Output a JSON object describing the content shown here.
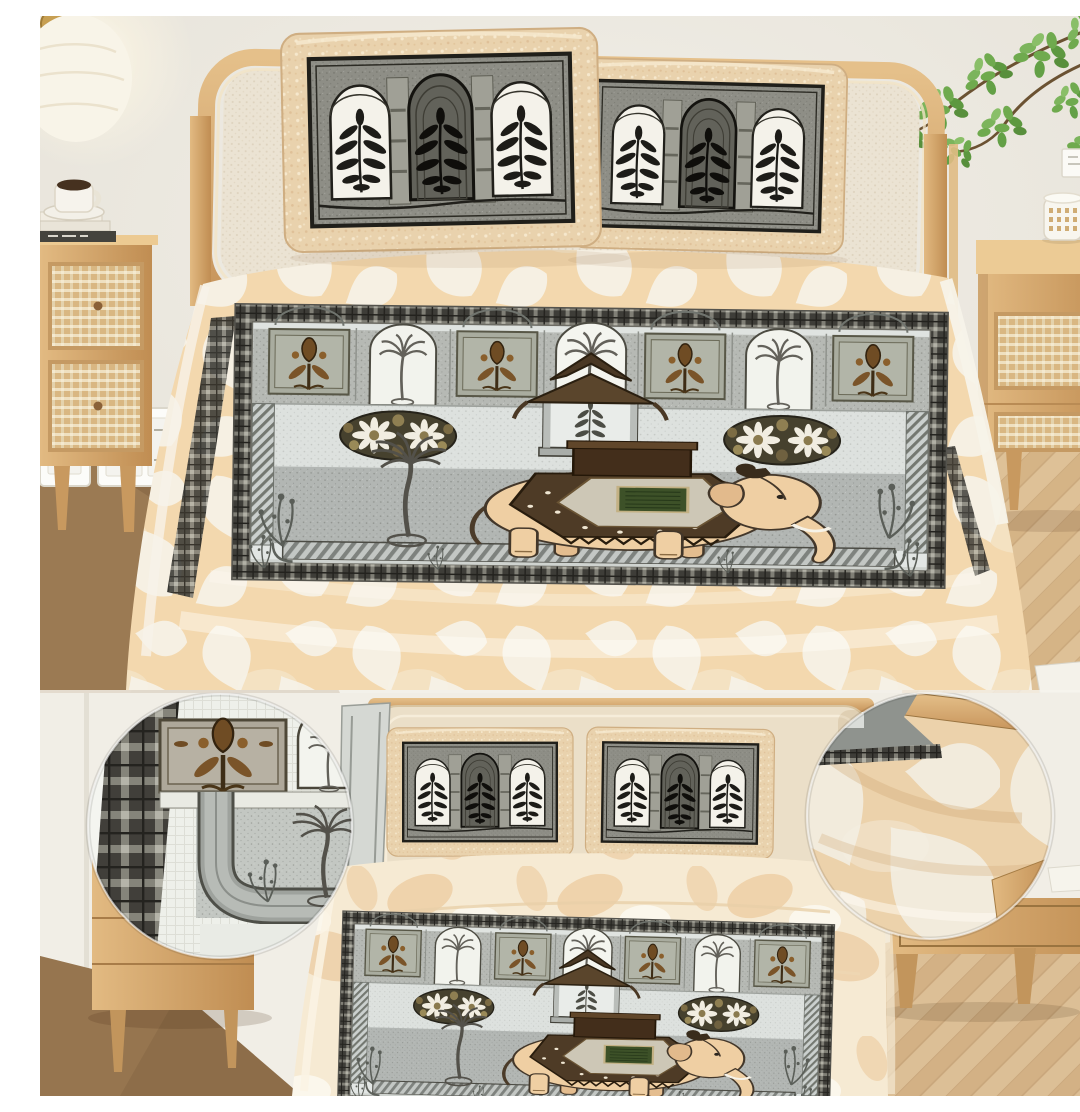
{
  "meta": {
    "title": "Elephant and Mughal-arch block-print jacquard bedsheet set with two pillow covers, styled bedroom product photo",
    "canvas": {
      "width": 1080,
      "height": 1080
    },
    "text_visible_in_image": false
  },
  "palette": {
    "wall": "#edeae2",
    "wall_shadow": "#e0dcd2",
    "wood": "#d5a873",
    "wood_dark": "#b9854f",
    "floor_dark": "#8d6d49",
    "floor_light": "#d6b488",
    "sheet_peach": "#f3d8ae",
    "leaf_white": "#f7f2e6",
    "sheet_cream": "#f6ead3",
    "marble_peach": "#ecca9e",
    "headboard_cream": "#ebdfc8",
    "print_black": "#1d1c18",
    "print_gray": "#8e8e86",
    "panel_field": "#b2b6b3",
    "panel_light": "#e2e6e4",
    "niche_wall": "#b6b9b4",
    "eleph": "#efcfa3",
    "blanket": "#4e3b26",
    "green_square": "#3d5128",
    "plant_green": "#6faa4e",
    "glow": "#fffdf4"
  },
  "scene": {
    "top": {
      "label": "Bedroom overview: wooden bed with cane headboard, two block-print pillow shams, peach leaf-jacquard bedsheet with large grey elephant panel, flanked by rattan nightstands, wall sconce, light switches and a green plant"
    },
    "bottom": {
      "label": "Detail strip: front view of the bed set with two magnified fabric close-ups",
      "center": {
        "label": "Front view of bed with two arch-print pillow shams and elephant panel sheet"
      },
      "left_detail": {
        "label": "Close-up circle: printed panel corner with checked border, arch plaques, palm and grey inner frame"
      },
      "right_detail": {
        "label": "Close-up circle: peach jacquard fabric with white leaf pattern draped over nightstand"
      }
    },
    "print": {
      "panel_motifs": [
        "checked plaid border",
        "seven arched niches with palms and brown poppies",
        "flower medallions",
        "pavilion with bouquet",
        "caparisoned elephant with green howdah cloth",
        "palm tree",
        "striped platform",
        "corner floral sprays"
      ],
      "pillow_motifs": [
        "triple Mughal arches",
        "black botanical bouquets",
        "peach quilted border"
      ]
    }
  }
}
